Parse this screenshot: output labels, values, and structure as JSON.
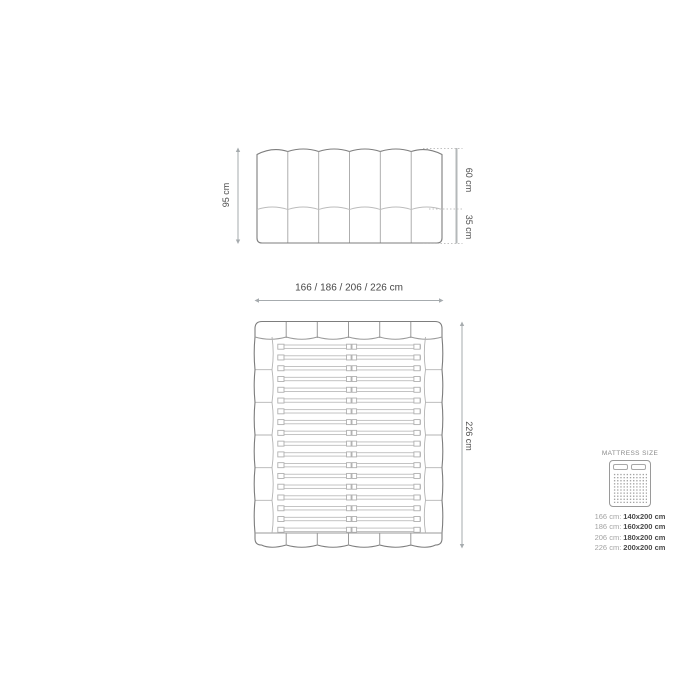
{
  "headboard_view": {
    "height_label": "95 cm",
    "upper_height_label": "60 cm",
    "lower_height_label": "35 cm"
  },
  "bed_view": {
    "width_label": "166 / 186 / 206 / 226 cm",
    "length_label": "226 cm",
    "slat_count": 18
  },
  "legend": {
    "title": "MATTRESS SIZE",
    "rows": [
      {
        "width": "166 cm:",
        "size": "140x200 cm"
      },
      {
        "width": "186 cm:",
        "size": "160x200 cm"
      },
      {
        "width": "206 cm:",
        "size": "180x200 cm"
      },
      {
        "width": "226 cm:",
        "size": "200x200 cm"
      }
    ]
  },
  "colors": {
    "outline": "#7d7d7d",
    "inner_line": "#bcbcbc",
    "dimension_line": "#a6abae",
    "text": "#4f4f4f",
    "muted_text": "#a3a3a3",
    "background": "#ffffff"
  }
}
